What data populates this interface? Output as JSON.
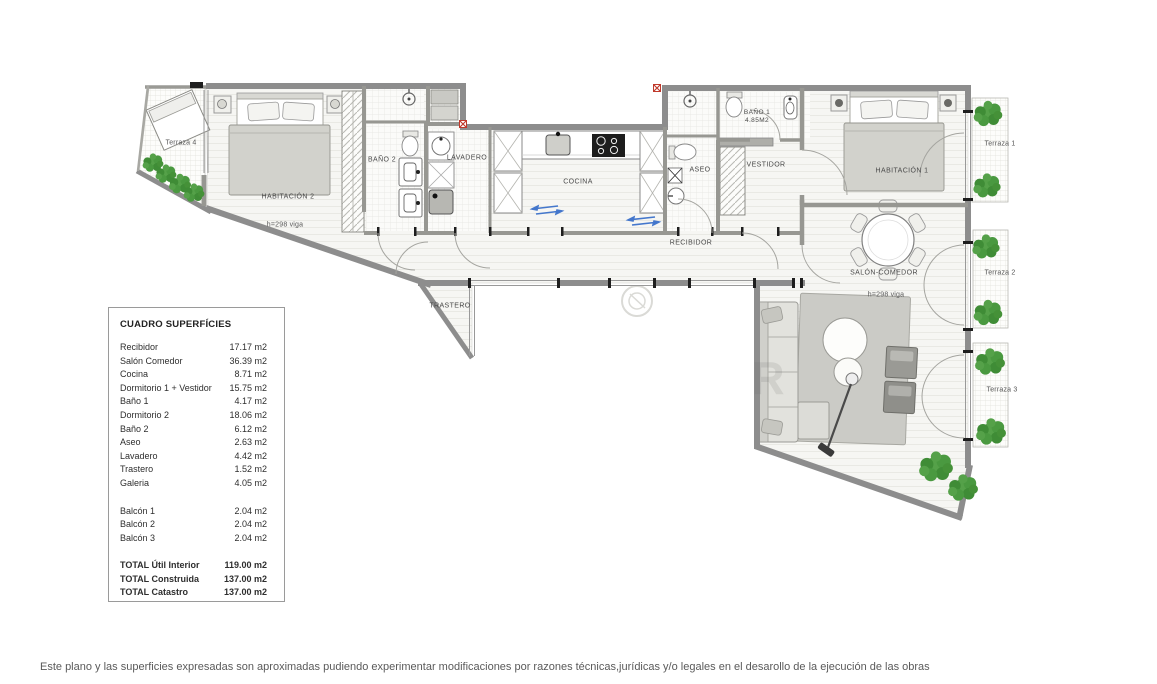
{
  "plan": {
    "labels": {
      "terraza4": "Terraza 4",
      "habitacion2": "HABITACIÓN 2",
      "viga2": "h=298 viga",
      "bano2": "BAÑO 2",
      "lavadero": "LAVADERO",
      "cocina": "COCINA",
      "aseo": "ASEO",
      "bano1_line1": "BAÑO 1",
      "bano1_line2": "4.85M2",
      "vestidor": "VESTIDOR",
      "habitacion1": "HABITACIÓN 1",
      "terraza1": "Terraza 1",
      "recibidor": "RECIBIDOR",
      "salon": "SALÓN-COMEDOR",
      "viga1": "h=298 viga",
      "terraza2": "Terraza 2",
      "trastero": "TRASTERO",
      "terraza3": "Terraza 3"
    },
    "watermark": "R",
    "colors": {
      "wall": "#8d8d8d",
      "interior_wall": "#979793",
      "bush_green": "#4a9940",
      "red_marker": "#c0392b",
      "blue_arrow": "#4477cc",
      "floor": "#f6f6f3"
    }
  },
  "table": {
    "title": "CUADRO SUPERFÍCIES",
    "rooms": [
      {
        "label": "Recibidor",
        "value": "17.17 m2"
      },
      {
        "label": "Salón Comedor",
        "value": "36.39 m2"
      },
      {
        "label": "Cocina",
        "value": "8.71 m2"
      },
      {
        "label": "Dormitorio 1 + Vestidor",
        "value": "15.75 m2"
      },
      {
        "label": "Baño 1",
        "value": "4.17 m2"
      },
      {
        "label": "Dormitorio 2",
        "value": "18.06 m2"
      },
      {
        "label": "Baño 2",
        "value": "6.12 m2"
      },
      {
        "label": "Aseo",
        "value": "2.63 m2"
      },
      {
        "label": "Lavadero",
        "value": "4.42 m2"
      },
      {
        "label": "Trastero",
        "value": "1.52 m2"
      },
      {
        "label": "Galeria",
        "value": "4.05 m2"
      }
    ],
    "balconies": [
      {
        "label": "Balcón 1",
        "value": "2.04 m2"
      },
      {
        "label": "Balcón 2",
        "value": "2.04 m2"
      },
      {
        "label": "Balcón 3",
        "value": "2.04 m2"
      }
    ],
    "totals": [
      {
        "label": "TOTAL Útil Interior",
        "value": "119.00 m2"
      },
      {
        "label": "TOTAL Construida",
        "value": "137.00 m2"
      },
      {
        "label": "TOTAL Catastro",
        "value": "137.00 m2"
      }
    ]
  },
  "footer": {
    "disclaimer": "Este plano y las superficies expresadas son aproximadas pudiendo experimentar modificaciones por razones técnicas,jurídicas y/o legales en el desarollo de la ejecución de las obras"
  }
}
